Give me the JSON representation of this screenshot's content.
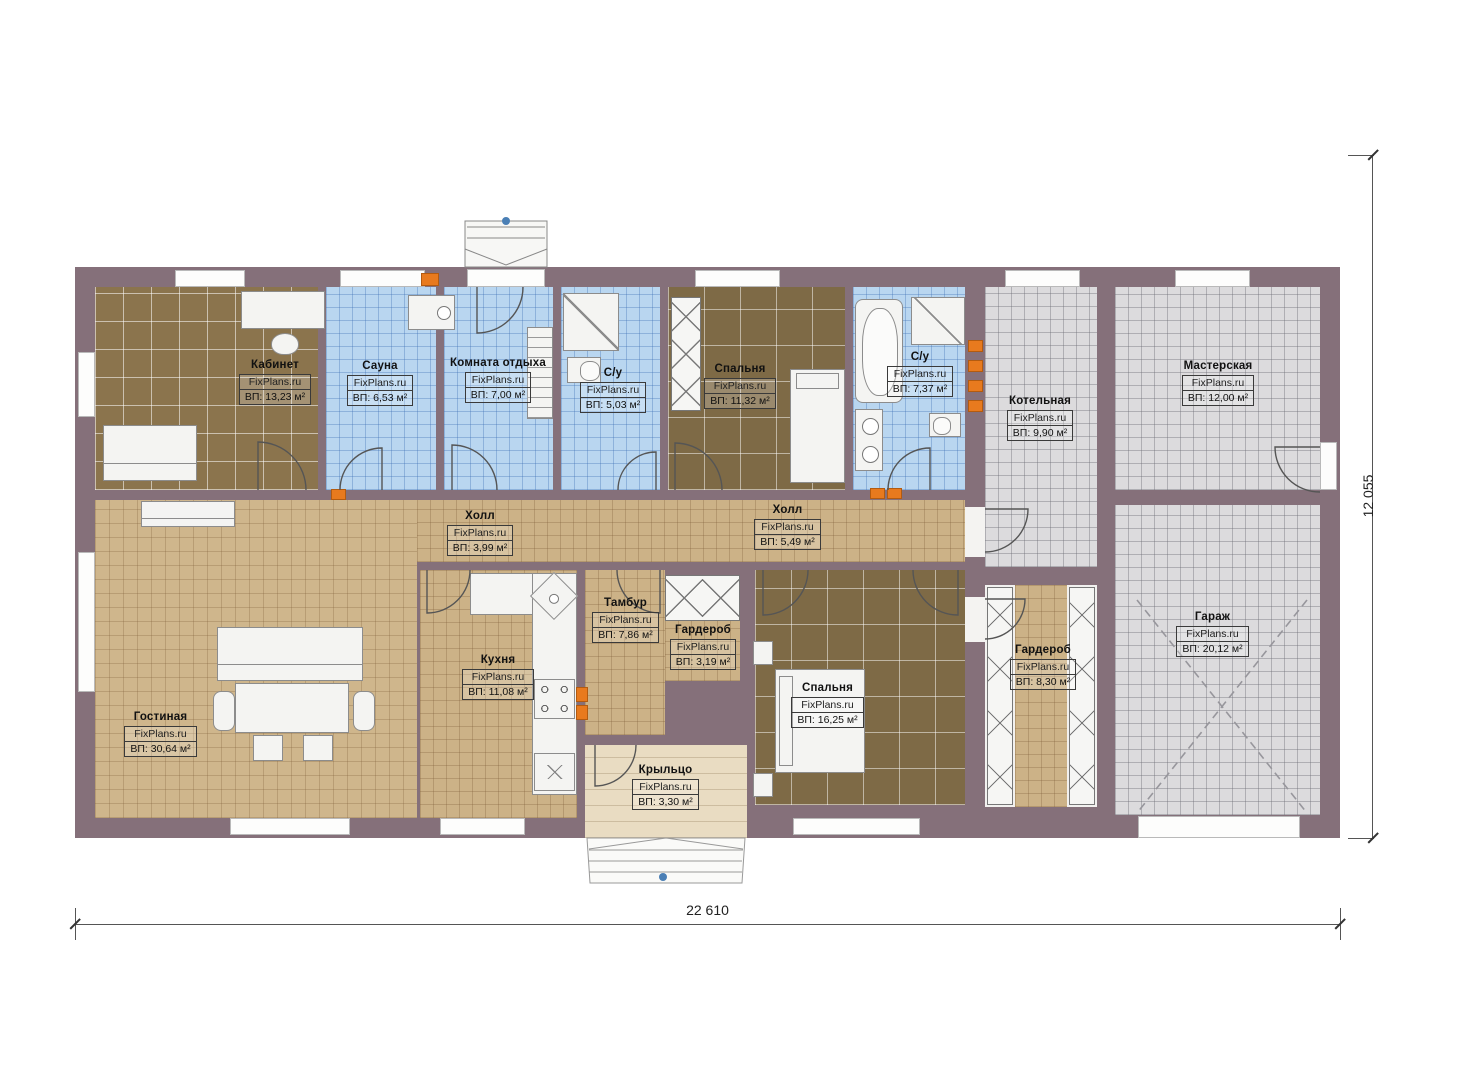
{
  "plan": {
    "watermark": "FixPlans.ru",
    "dim_width": "22 610",
    "dim_height": "12 055",
    "rooms": [
      {
        "name": "Кабинет",
        "area": "ВП: 13,23 м²"
      },
      {
        "name": "Сауна",
        "area": "ВП: 6,53 м²"
      },
      {
        "name": "Комната отдыха",
        "area": "ВП: 7,00 м²"
      },
      {
        "name": "С/у",
        "area": "ВП: 5,03 м²"
      },
      {
        "name": "Спальня",
        "area": "ВП: 11,32 м²"
      },
      {
        "name": "С/у",
        "area": "ВП: 7,37 м²"
      },
      {
        "name": "Котельная",
        "area": "ВП: 9,90 м²"
      },
      {
        "name": "Мастерская",
        "area": "ВП: 12,00 м²"
      },
      {
        "name": "Холл",
        "area": "ВП: 3,99 м²"
      },
      {
        "name": "Холл",
        "area": "ВП: 5,49 м²"
      },
      {
        "name": "Гостиная",
        "area": "ВП: 30,64 м²"
      },
      {
        "name": "Кухня",
        "area": "ВП: 11,08 м²"
      },
      {
        "name": "Тамбур",
        "area": "ВП: 7,86 м²"
      },
      {
        "name": "Гардероб",
        "area": "ВП: 3,19 м²"
      },
      {
        "name": "Спальня",
        "area": "ВП: 16,25 м²"
      },
      {
        "name": "Гардероб",
        "area": "ВП: 8,30 м²"
      },
      {
        "name": "Гараж",
        "area": "ВП: 20,12 м²"
      },
      {
        "name": "Крыльцо",
        "area": "ВП: 3,30 м²"
      }
    ]
  }
}
